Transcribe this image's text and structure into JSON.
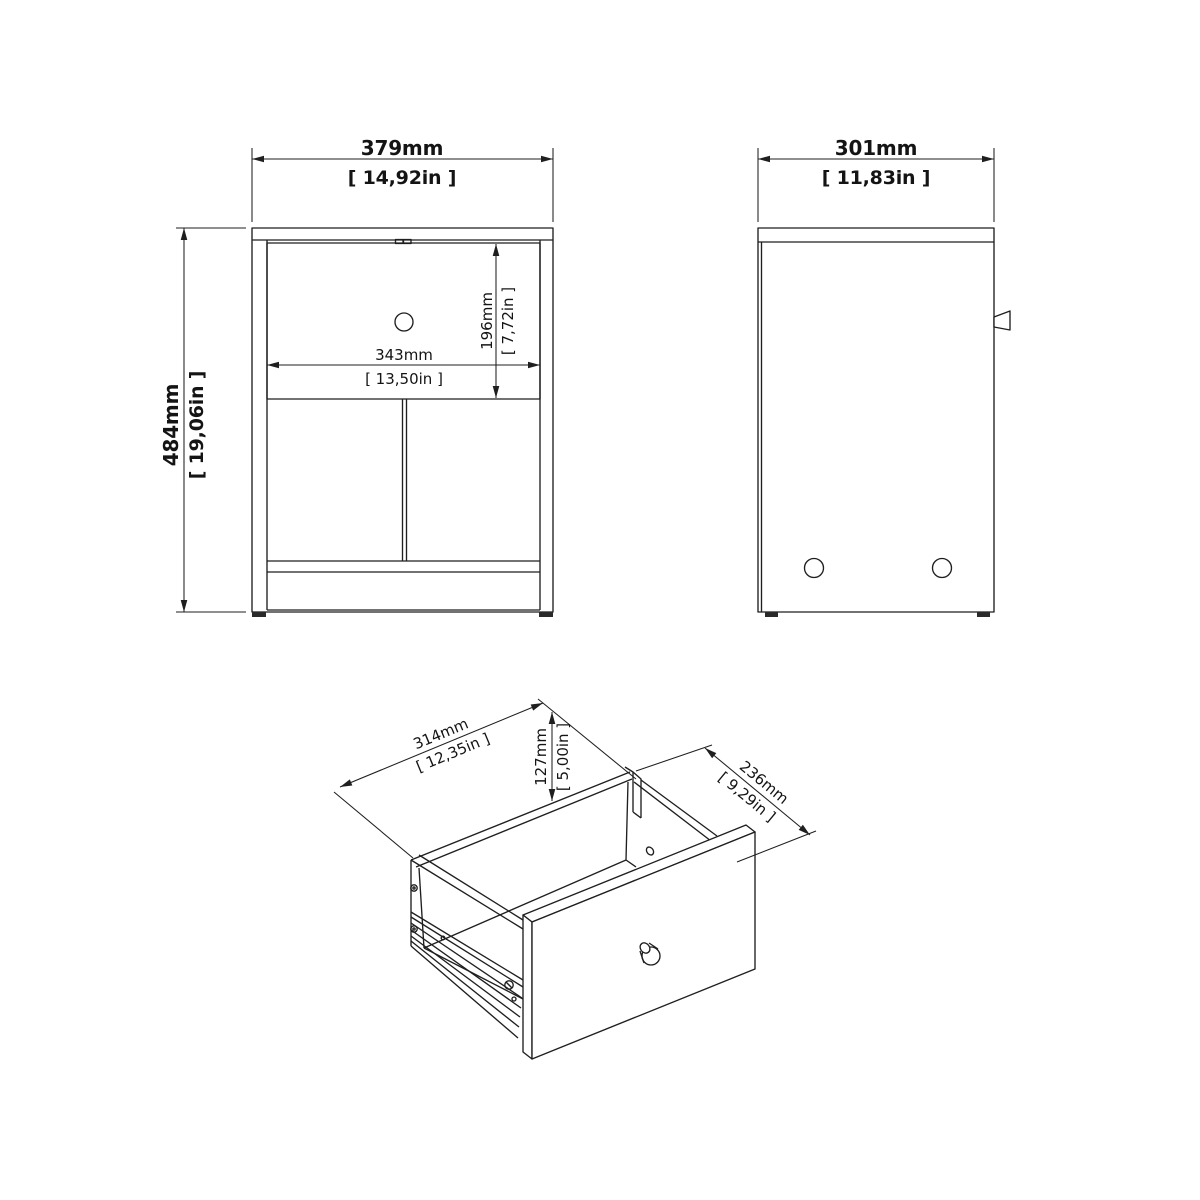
{
  "drawing": {
    "type": "furniture-technical-drawing",
    "colors": {
      "line": "#1f1f1f",
      "background": "#ffffff"
    },
    "front_view": {
      "width_mm": "379mm",
      "width_in": "[ 14,92in ]",
      "height_mm": "484mm",
      "height_in": "[ 19,06in ]",
      "drawer_width_mm": "343mm",
      "drawer_width_in": "[ 13,50in ]",
      "drawer_height_mm": "196mm",
      "drawer_height_in": "[ 7,72in ]"
    },
    "side_view": {
      "depth_mm": "301mm",
      "depth_in": "[ 11,83in ]"
    },
    "drawer_view": {
      "width_mm": "314mm",
      "width_in": "[ 12,35in ]",
      "height_mm": "127mm",
      "height_in": "[ 5,00in ]",
      "depth_mm": "236mm",
      "depth_in": "[ 9,29in ]"
    }
  }
}
